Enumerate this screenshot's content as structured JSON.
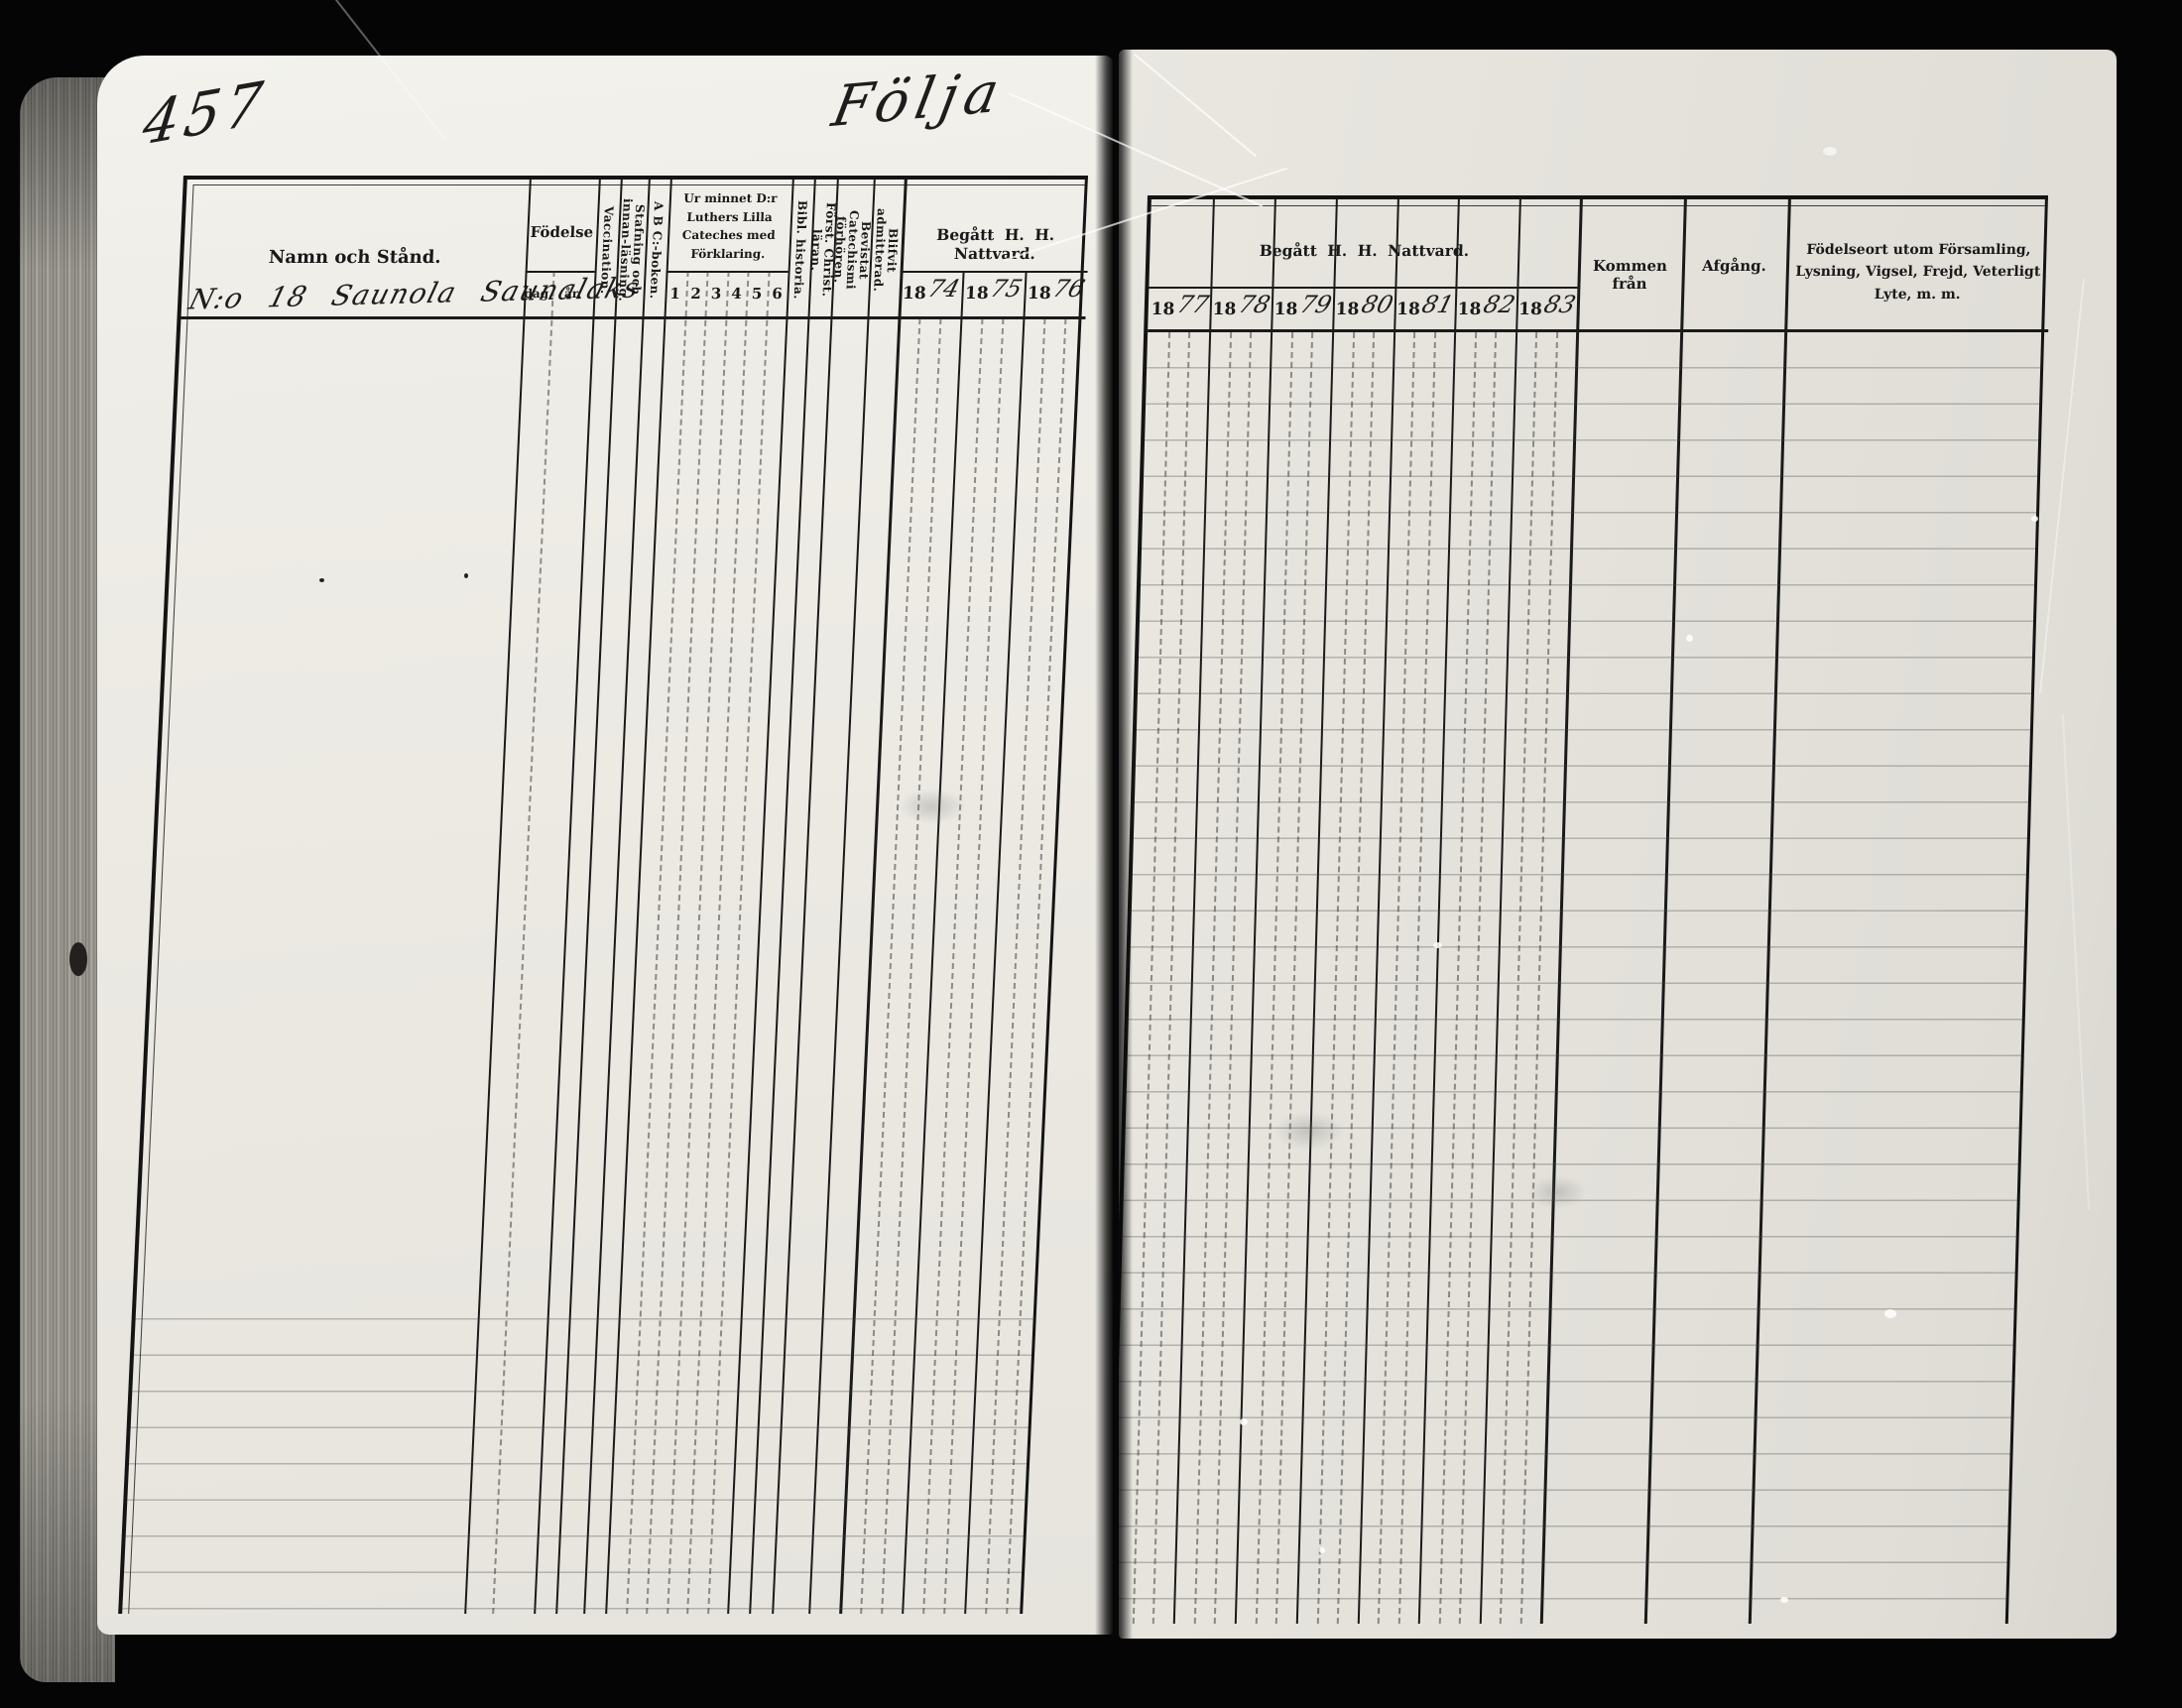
{
  "scan": {
    "page_number": "457",
    "page_title_script": "Följa",
    "entry_line": "N:o 18 Saunola Saunalaks"
  },
  "left_table": {
    "name_header": "Namn och Stånd.",
    "birth_header": "Födelse",
    "birth_day": "dag.",
    "birth_year": "år.",
    "vaccination": "Vaccination.",
    "spelling_reading": "Stafning och innan-läsning.",
    "abc_book": "A B C:-boken.",
    "catechism_block": "Ur minnet D:r Luthers Lilla Cateches med Förklaring.",
    "catechism_cols": [
      "1",
      "2",
      "3",
      "4",
      "5",
      "6"
    ],
    "bible_history": "Bibl. historia.",
    "christian_doctrine": "Först. Christ. läran.",
    "catechism_exams": "Bevistat Catechismi förhören.",
    "admitted": "Blifvit admitterad.",
    "communion_header": "Begått H. H. Nattvard.",
    "communion_years": [
      {
        "printed": "18",
        "written": "74"
      },
      {
        "printed": "18",
        "written": "75"
      },
      {
        "printed": "18",
        "written": "76"
      }
    ]
  },
  "right_table": {
    "communion_header": "Begått H. H. Nattvard.",
    "communion_years": [
      {
        "printed": "18",
        "written": "77"
      },
      {
        "printed": "18",
        "written": "78"
      },
      {
        "printed": "18",
        "written": "79"
      },
      {
        "printed": "18",
        "written": "80"
      },
      {
        "printed": "18",
        "written": "81"
      },
      {
        "printed": "18",
        "written": "82"
      },
      {
        "printed": "18",
        "written": "83"
      }
    ],
    "came_from": "Kommen från",
    "departure": "Afgång.",
    "birthplace_notes": "Födelseort utom Församling, Lysning, Vigsel, Frejd, Veterligt Lyte, m. m."
  },
  "colors": {
    "background": "#050505",
    "paper_left": "#efede7",
    "paper_right": "#e2e0d9",
    "ink": "#1a1a1a"
  }
}
